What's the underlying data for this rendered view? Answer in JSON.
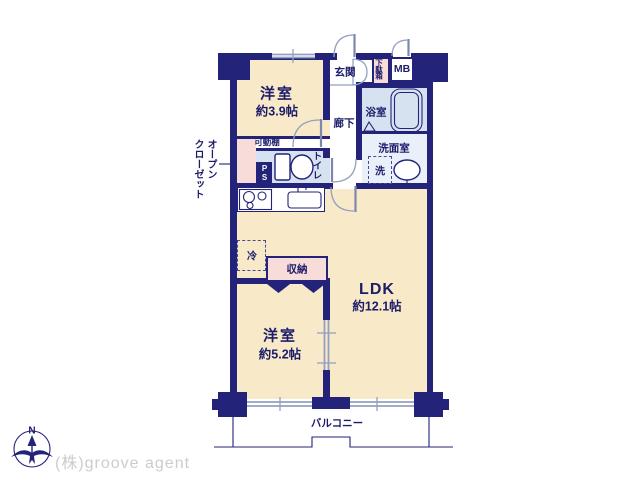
{
  "company": "(株)groove agent",
  "compass": {
    "north": "N"
  },
  "labels": {
    "bedroom1": {
      "name": "洋室",
      "size": "約3.9帖"
    },
    "bedroom2": {
      "name": "洋室",
      "size": "約5.2帖"
    },
    "ldk": {
      "name": "LDK",
      "size": "約12.1帖"
    },
    "entrance": "玄関",
    "hallway": "廊下",
    "bathroom": "浴室",
    "washroom": "洗面室",
    "toilet": "トイレ",
    "meter_box": "MB",
    "shoe_box": "下駄箱",
    "pipe_shaft": "PS",
    "movable_shelf": "可動棚",
    "open_closet_line1": "オープン",
    "open_closet_line2": "クローゼット",
    "storage": "収納",
    "fridge": "冷",
    "washer": "洗",
    "balcony": "バルコニー"
  },
  "colors": {
    "wall_navy": "#23237a",
    "text_navy": "#1c1c69",
    "room_cream": "#f8e9c8",
    "closet_pink": "#f8dcda",
    "wet_area_blue": "#d7e2f1",
    "washroom_blue": "#eaf0f9",
    "window_gray": "#93a0c0",
    "company_gray": "#cccccc"
  }
}
